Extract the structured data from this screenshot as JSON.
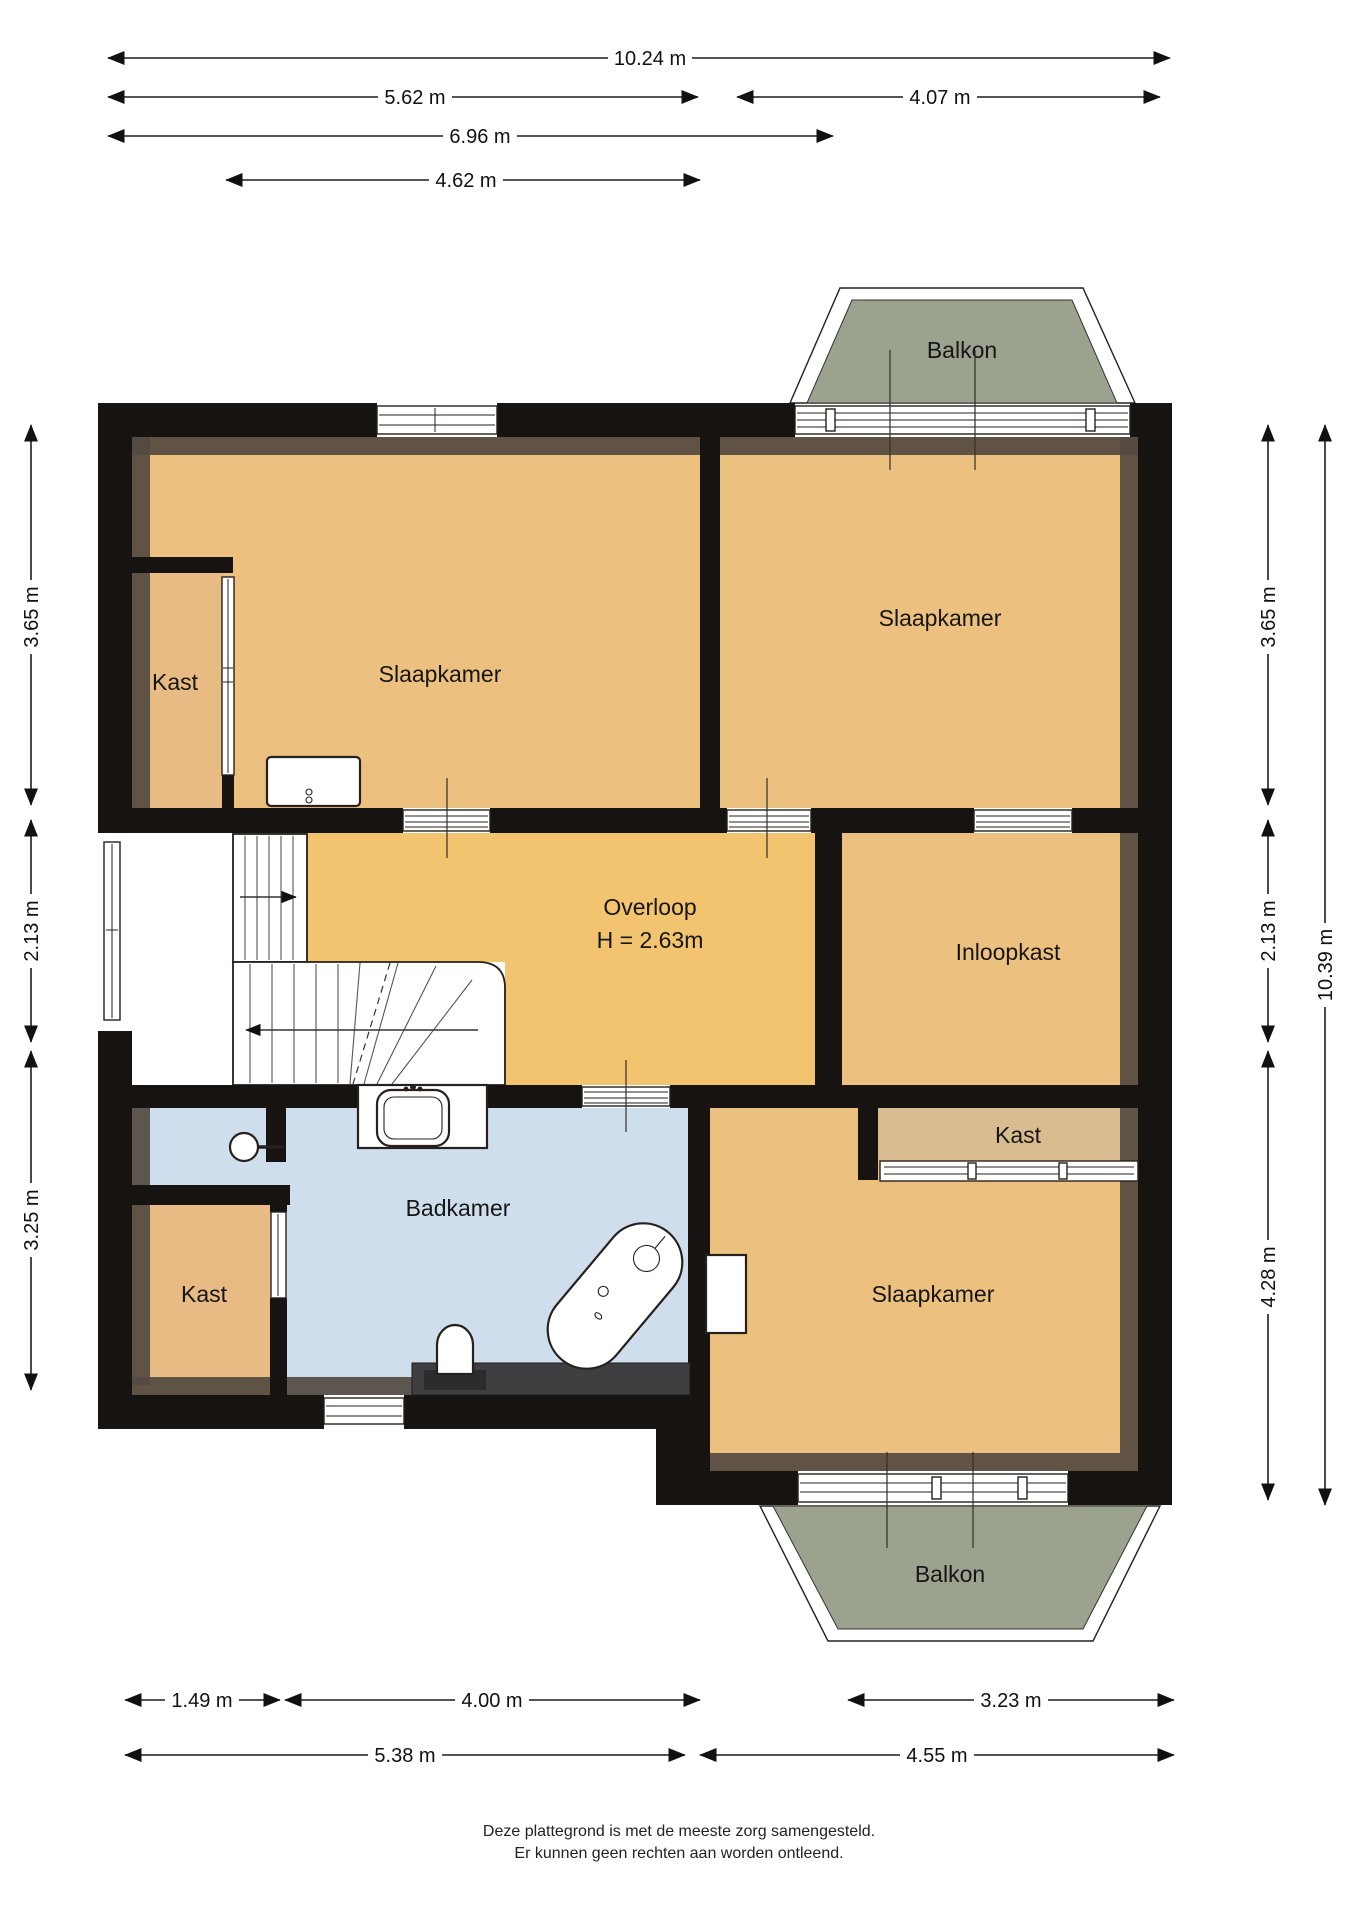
{
  "plan": {
    "footer": [
      "Deze plattegrond is met de meeste zorg samengesteld.",
      "Er kunnen geen rechten aan worden ontleend."
    ],
    "rooms": {
      "bedroom_top_left": "Slaapkamer",
      "bedroom_top_right": "Slaapkamer",
      "bedroom_bottom": "Slaapkamer",
      "closet_top_left": "Kast",
      "closet_bottom_left": "Kast",
      "closet_bedroom": "Kast",
      "walk_in_closet": "Inloopkast",
      "landing": "Overloop",
      "landing_height": "H = 2.63m",
      "bathroom": "Badkamer",
      "balcony_top": "Balkon",
      "balcony_bottom": "Balkon"
    },
    "dimensions": {
      "top": [
        "10.24 m",
        "5.62 m",
        "4.07 m",
        "6.96 m",
        "4.62 m"
      ],
      "left": [
        "3.65 m",
        "2.13 m",
        "3.25 m"
      ],
      "right": [
        "3.65 m",
        "2.13 m",
        "4.28 m",
        "10.39 m"
      ],
      "bottom": [
        "1.49 m",
        "4.00 m",
        "3.23 m",
        "5.38 m",
        "4.55 m"
      ]
    },
    "colors": {
      "wall": "#171311",
      "shading": "#544a41",
      "floor": "#ecc07f",
      "landing_floor": "#f3c470",
      "closet_floor": "#d9bd90",
      "closet_small_floor": "#e7bb83",
      "bathroom_floor": "#cfdeed",
      "balcony": "#9ba28e"
    }
  }
}
